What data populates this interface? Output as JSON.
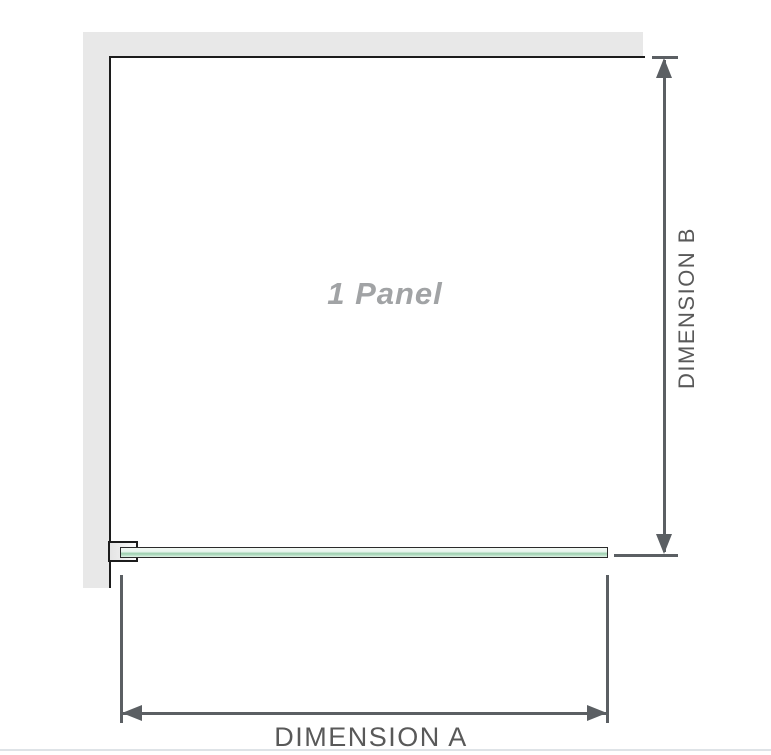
{
  "diagram": {
    "panel_label": "1 Panel",
    "dimension_a_label": "DIMENSION A",
    "dimension_b_label": "DIMENSION B"
  },
  "colors": {
    "wall": "#e8e8e8",
    "outline": "#1c1c1c",
    "bracket_fill": "#ececec",
    "glass_border": "#2b2b2b",
    "glass_light": "#e9f5ee",
    "glass_mid": "#9ccfae",
    "dim_line": "#5b5f63",
    "dim_text": "#595959",
    "panel_text": "#a1a3a5",
    "divider": "#dee3e7"
  }
}
